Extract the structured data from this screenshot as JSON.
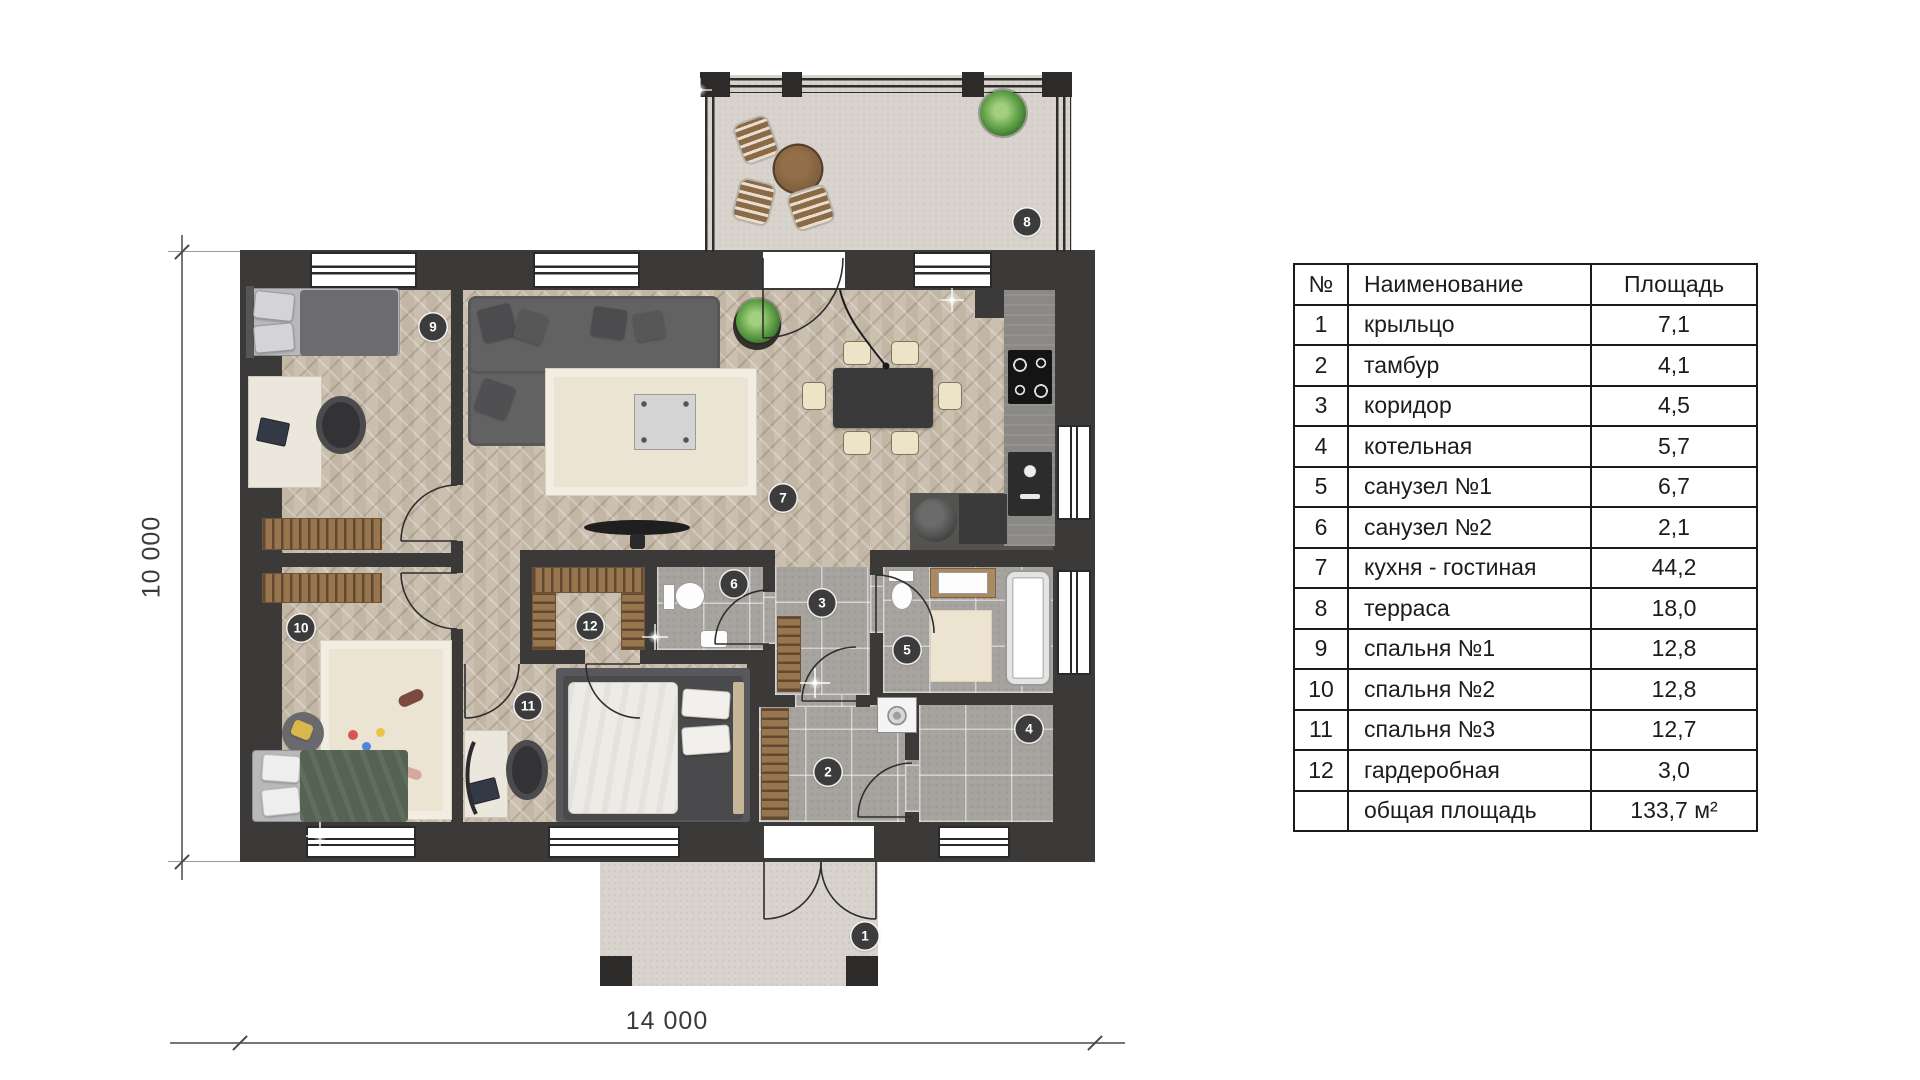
{
  "colors": {
    "wall": "#3b3a38",
    "marker": "#3c3c3c",
    "wood_floor": "#c8bcab",
    "tile_floor": "#a7a49f",
    "stone_floor": "#d8d4cd"
  },
  "plan": {
    "dimensions": {
      "width_label": "14 000",
      "height_label": "10 000"
    },
    "markers": [
      {
        "label": "1",
        "x": 865,
        "y": 936
      },
      {
        "label": "2",
        "x": 828,
        "y": 772
      },
      {
        "label": "3",
        "x": 822,
        "y": 603
      },
      {
        "label": "4",
        "x": 1029,
        "y": 729
      },
      {
        "label": "5",
        "x": 907,
        "y": 650
      },
      {
        "label": "6",
        "x": 734,
        "y": 584
      },
      {
        "label": "7",
        "x": 783,
        "y": 498
      },
      {
        "label": "8",
        "x": 1027,
        "y": 222
      },
      {
        "label": "9",
        "x": 433,
        "y": 327
      },
      {
        "label": "10",
        "x": 301,
        "y": 628
      },
      {
        "label": "11",
        "x": 528,
        "y": 706
      },
      {
        "label": "12",
        "x": 590,
        "y": 626
      }
    ]
  },
  "table": {
    "headers": {
      "num": "№",
      "name": "Наименование",
      "area": "Площадь"
    },
    "rows": [
      {
        "num": "1",
        "name": "крыльцо",
        "area": "7,1"
      },
      {
        "num": "2",
        "name": "тамбур",
        "area": "4,1"
      },
      {
        "num": "3",
        "name": "коридор",
        "area": "4,5"
      },
      {
        "num": "4",
        "name": "котельная",
        "area": "5,7"
      },
      {
        "num": "5",
        "name": "санузел №1",
        "area": "6,7"
      },
      {
        "num": "6",
        "name": "санузел №2",
        "area": "2,1"
      },
      {
        "num": "7",
        "name": "кухня - гостиная",
        "area": "44,2"
      },
      {
        "num": "8",
        "name": "терраса",
        "area": "18,0"
      },
      {
        "num": "9",
        "name": "спальня №1",
        "area": "12,8"
      },
      {
        "num": "10",
        "name": "спальня №2",
        "area": "12,8"
      },
      {
        "num": "11",
        "name": "спальня №3",
        "area": "12,7"
      },
      {
        "num": "12",
        "name": "гардеробная",
        "area": "3,0"
      },
      {
        "num": "",
        "name": "общая площадь",
        "area": "133,7 м²"
      }
    ]
  }
}
